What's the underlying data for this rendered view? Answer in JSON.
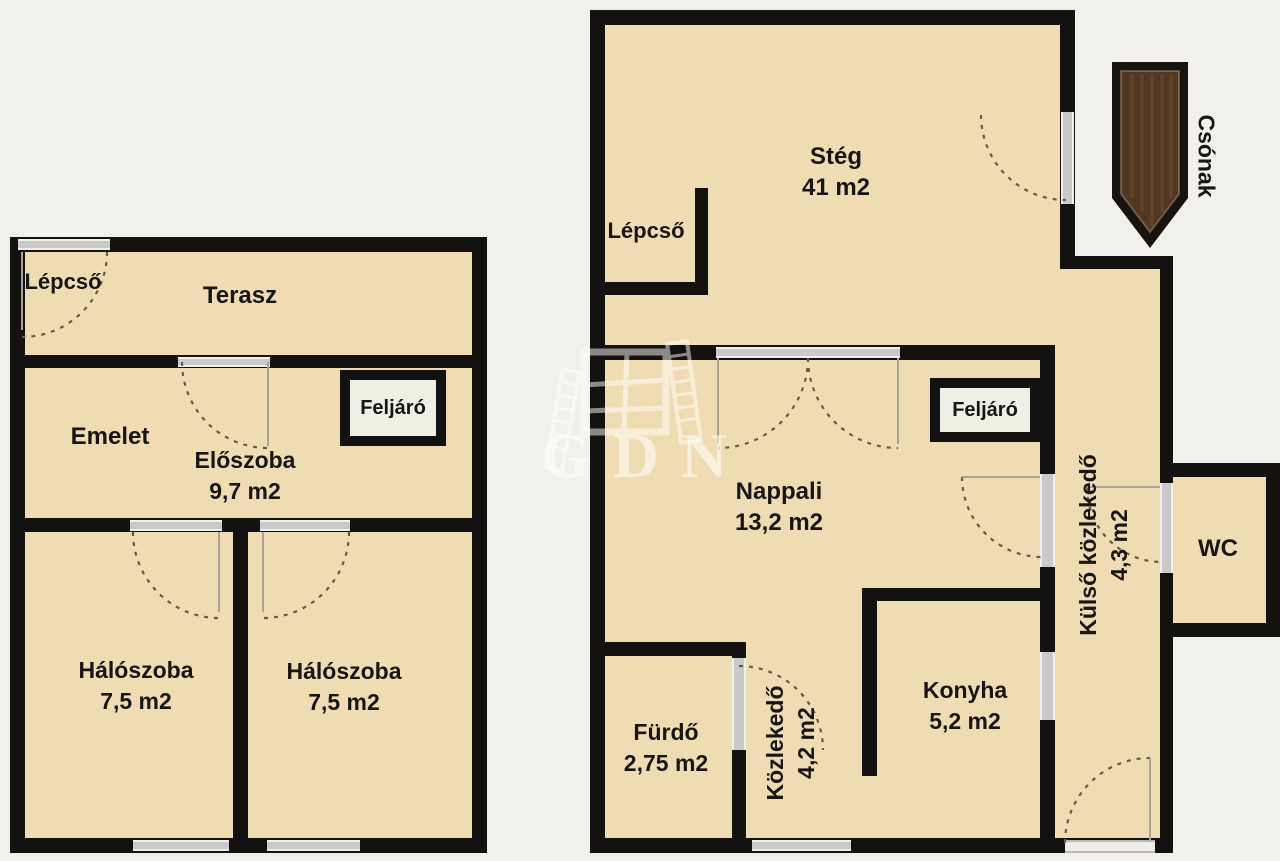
{
  "watermark": {
    "text": "GDN"
  },
  "rooms": {
    "lepcso_left": {
      "label": "Lépcső"
    },
    "terasz": {
      "label": "Terasz"
    },
    "emelet": {
      "label": "Emelet"
    },
    "eloszoba": {
      "label": "Előszoba",
      "area": "9,7 m2"
    },
    "feljaro_left": {
      "label": "Feljáró"
    },
    "haloszoba_1": {
      "label": "Hálószoba",
      "area": "7,5 m2"
    },
    "haloszoba_2": {
      "label": "Hálószoba",
      "area": "7,5 m2"
    },
    "steg": {
      "label": "Stég",
      "area": "41 m2"
    },
    "lepcso_right": {
      "label": "Lépcső"
    },
    "feljaro_right": {
      "label": "Feljáró"
    },
    "nappali": {
      "label": "Nappali",
      "area": "13,2 m2"
    },
    "furdo": {
      "label": "Fürdő",
      "area": "2,75 m2"
    },
    "kozlekedo": {
      "label": "Közlekedő",
      "area": "4,2 m2"
    },
    "konyha": {
      "label": "Konyha",
      "area": "5,2 m2"
    },
    "kulso_kozlekedo": {
      "label": "Külső közlekedő",
      "area": "4,3 m2"
    },
    "wc": {
      "label": "WC"
    },
    "csonak": {
      "label": "Csónak"
    }
  },
  "colors": {
    "background": "#f2f0eb",
    "floor": "#f0dcb2",
    "wall": "#141210",
    "window": "#c9c9c9",
    "feljaro_fill": "#edf0e3",
    "boat_wood": "#503823",
    "watermark": "rgba(255,255,255,0.55)"
  }
}
